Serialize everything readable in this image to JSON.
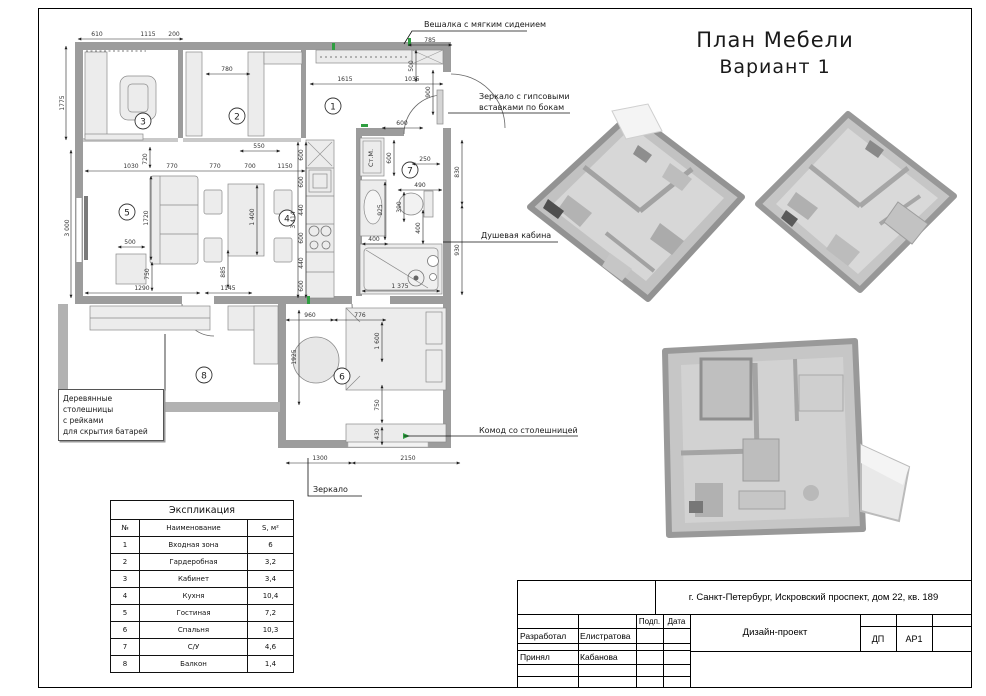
{
  "sheet": {
    "title_line1": "План Мебели",
    "title_line2": "Вариант 1"
  },
  "annotations": {
    "hanger": "Вешалка с мягким сидением",
    "mirror_gypsum_line1": "Зеркало с гипсовыми",
    "mirror_gypsum_line2": "вставками по бокам",
    "shower": "Душевая кабина",
    "commode": "Комод со столешницей",
    "mirror": "Зеркало",
    "worktop_line1": "Деревянные столешницы",
    "worktop_line2": "с рейками",
    "worktop_line3": "для скрытия батарей"
  },
  "room_numbers": [
    "1",
    "2",
    "3",
    "4",
    "5",
    "6",
    "7",
    "8"
  ],
  "plan": {
    "washer_label": "Ст.М."
  },
  "dims": {
    "d200": "200",
    "d250": "250",
    "d390": "390",
    "d400": "400",
    "d430": "430",
    "d440": "440",
    "d490": "490",
    "d500": "500",
    "d550": "550",
    "d600": "600",
    "d610": "610",
    "d700": "700",
    "d720": "720",
    "d750": "750",
    "d770": "770",
    "d776": "776",
    "d780": "780",
    "d785": "785",
    "d830": "830",
    "d885": "885",
    "d900": "900",
    "d925": "925",
    "d930": "930",
    "d960": "960",
    "d1030": "1030",
    "d1035": "1035",
    "d1115": "1115",
    "d1145": "1145",
    "d1150": "1150",
    "d1290": "1290",
    "d1300": "1300",
    "d1375": "1 375",
    "d1400": "1 400",
    "d1600": "1 600",
    "d1615": "1615",
    "d1720": "1720",
    "d1775": "1775",
    "d1925": "1925",
    "d2150": "2150",
    "d3000": "3 000",
    "d3414": "3 414"
  },
  "legend": {
    "title": "Экспликация",
    "headers": {
      "num": "№",
      "name": "Наименование",
      "area": "S, м²"
    },
    "rows": [
      {
        "num": "1",
        "name": "Входная зона",
        "area": "6"
      },
      {
        "num": "2",
        "name": "Гардеробная",
        "area": "3,2"
      },
      {
        "num": "3",
        "name": "Кабинет",
        "area": "3,4"
      },
      {
        "num": "4",
        "name": "Кухня",
        "area": "10,4"
      },
      {
        "num": "5",
        "name": "Гостиная",
        "area": "7,2"
      },
      {
        "num": "6",
        "name": "Спальня",
        "area": "10,3"
      },
      {
        "num": "7",
        "name": "С/У",
        "area": "4,6"
      },
      {
        "num": "8",
        "name": "Балкон",
        "area": "1,4"
      }
    ]
  },
  "title_block": {
    "address": "г. Санкт-Петербург, Искровский проспект, дом 22, кв. 189",
    "developed_label": "Разработал",
    "developed_name": "Елистратова",
    "sign_label": "Подп.",
    "date_label": "Дата",
    "project": "Дизайн-проект",
    "accepted_label": "Принял",
    "accepted_name": "Кабанова",
    "code_dp": "ДП",
    "code_ar1": "АР1"
  },
  "colors": {
    "wall": "#9c9c9c",
    "accent_green": "#2e9e40",
    "render_gray": "#c6c6c6"
  }
}
